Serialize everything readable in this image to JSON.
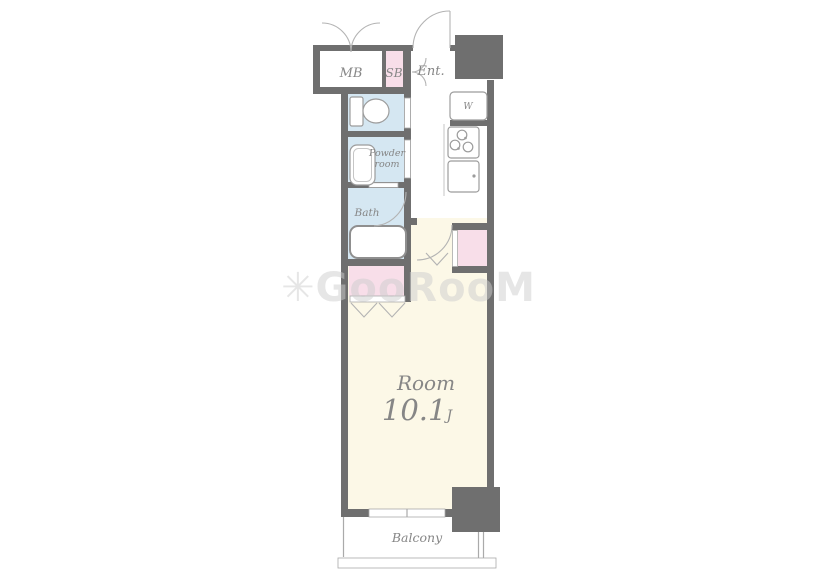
{
  "watermark": "✳GooRooM",
  "rooms": {
    "mb": "MB",
    "sb": "SB",
    "entrance": "Ent.",
    "washer": "W",
    "powder_line1": "Powder",
    "powder_line2": "room",
    "bath": "Bath",
    "main_room_name": "Room",
    "main_room_size": "10.1",
    "main_room_size_unit": "J",
    "balcony": "Balcony"
  },
  "colors": {
    "wall": "#6f6f6f",
    "main_room_floor": "#fcf8e7",
    "wet_room_floor": "#d5e7f2",
    "closet_fill": "#f8dee9",
    "fixture_stroke": "#9c9c9c",
    "label_text": "#868686"
  }
}
